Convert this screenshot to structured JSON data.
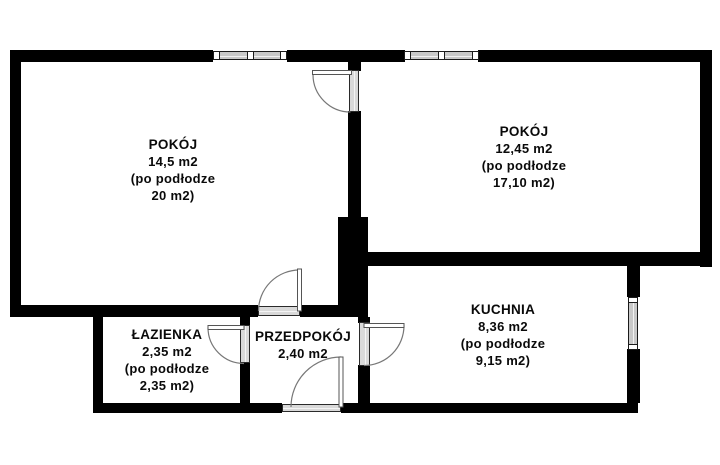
{
  "plan": {
    "title": "apartment floor plan",
    "colors": {
      "wall": "#000000",
      "background": "#ffffff",
      "window_fill": "#c9c9c9",
      "door_frame_fill": "#d9d9d9",
      "door_arc": "#777777"
    },
    "rooms": [
      {
        "id": "pokoj-left",
        "name": "POKÓJ",
        "area": "14,5 m2",
        "floor_note_1": "(po podłodze",
        "floor_note_2": "20 m2)"
      },
      {
        "id": "pokoj-right",
        "name": "POKÓJ",
        "area": "12,45 m2",
        "floor_note_1": "(po podłodze",
        "floor_note_2": "17,10 m2)"
      },
      {
        "id": "kuchnia",
        "name": "KUCHNIA",
        "area": "8,36 m2",
        "floor_note_1": "(po podłodze",
        "floor_note_2": "9,15 m2)"
      },
      {
        "id": "lazienka",
        "name": "ŁAZIENKA",
        "area": "2,35 m2",
        "floor_note_1": "(po podłodze",
        "floor_note_2": "2,35 m2)"
      },
      {
        "id": "przedpokoj",
        "name": "PRZEDPOKÓJ",
        "area": "2,40 m2"
      }
    ]
  }
}
